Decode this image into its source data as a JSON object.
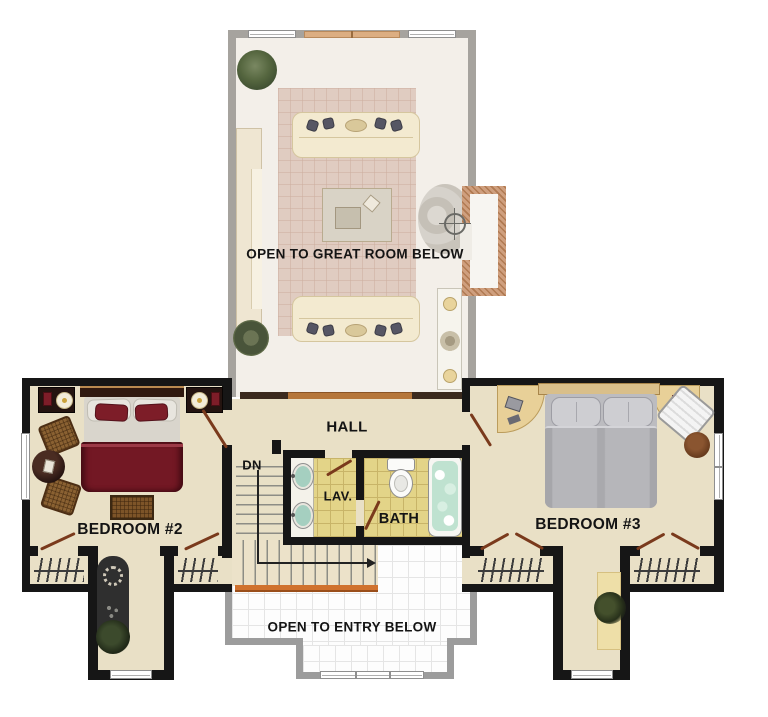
{
  "title": "Second Floor Plan",
  "labels": {
    "open_great_room": "OPEN TO GREAT ROOM BELOW",
    "hall": "HALL",
    "dn": "DN",
    "lav": "LAV.",
    "bath": "BATH",
    "bedroom2": "BEDROOM #2",
    "bedroom3": "BEDROOM #3",
    "open_entry": "OPEN TO ENTRY BELOW"
  },
  "rooms": [
    {
      "name": "Open to Great Room Below",
      "type": "void-overlook"
    },
    {
      "name": "Hall",
      "type": "hall"
    },
    {
      "name": "Lavatory",
      "type": "bath"
    },
    {
      "name": "Bath",
      "type": "bath"
    },
    {
      "name": "Bedroom #2",
      "type": "bedroom"
    },
    {
      "name": "Bedroom #3",
      "type": "bedroom"
    },
    {
      "name": "Open to Entry Below",
      "type": "void-overlook"
    },
    {
      "name": "Stairs Down",
      "type": "stairs"
    }
  ],
  "palette": {
    "wall_black": "#161616",
    "wall_gray_faded": "#a6a39e",
    "floor_tan": "#e9e0c6",
    "floor_great_room": "#f3efe9",
    "bath_tile_yellow": "#e3d488",
    "tub_water_mint": "#bfe2d0",
    "sink_teal": "#a5cfc0",
    "bed2_maroon": "#731824",
    "bed3_gray": "#b2b2b6",
    "rug_pink": "#e0ccc1",
    "sofa_cream": "#f3ead0",
    "railing_orange": "#d0722e",
    "door_swing_brown": "#7a3a1c"
  }
}
